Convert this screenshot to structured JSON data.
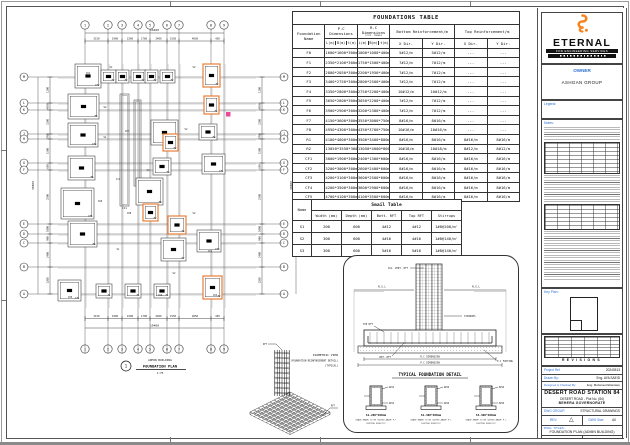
{
  "colors": {
    "accent_orange": "#F5841F",
    "label_blue": "#2E6FD0",
    "highlight_orange": "#E87E3A",
    "marker_pink": "#EC4899"
  },
  "foundations_table": {
    "title": "FOUNDATIONS TABLE",
    "col1": "Foundation Name",
    "pc_header": "P.C Dimensions",
    "rc_header": "R.C Dimensions",
    "rc_subheader": "(col. base)",
    "bottom_header": "Bottom Reinforcement/m",
    "top_header": "Top Reinforcement/m",
    "dim_subcols": [
      "L(m)",
      "B(m)",
      "t(m)"
    ],
    "xdir": "X Dir.",
    "ydir": "Y Dir.",
    "rows": [
      [
        "F0",
        "1600*1600*300mm",
        "1000*1000*400mm",
        "5#12/m",
        "5#12/m",
        "---",
        "---"
      ],
      [
        "F1",
        "2350*2100*300mm",
        "1750*1500*400mm",
        "7#12/m",
        "7#12/m",
        "---",
        "---"
      ],
      [
        "F2",
        "2800*2050*300mm",
        "2200*1950*400mm",
        "7#12/m",
        "7#12/m",
        "---",
        "---"
      ],
      [
        "F3",
        "3400*2750*300mm",
        "2800*2500*400mm",
        "7#12/m",
        "7#12/m",
        "---",
        "---"
      ],
      [
        "F4",
        "3350*2800*300mm",
        "2750*2200*400mm",
        "10#12/m",
        "10#12/m",
        "---",
        "---"
      ],
      [
        "F5",
        "3650*2800*300mm",
        "3050*2200*400mm",
        "7#12/m",
        "7#12/m",
        "---",
        "---"
      ],
      [
        "F6",
        "3900*2900*300mm",
        "3200*2300*400mm",
        "7#12/m",
        "7#12/m",
        "---",
        "---"
      ],
      [
        "F7",
        "4150*3600*300mm",
        "3550*3000*750mm",
        "8#16/m",
        "8#16/m",
        "---",
        "---"
      ],
      [
        "F8",
        "4950*4300*300mm",
        "4350*3700*750mm",
        "10#16/m",
        "10#16/m",
        "---",
        "---"
      ],
      [
        "R1",
        "4100*4000*300mm",
        "3500*3400*800mm",
        "8#16/m",
        "8#16/m",
        "8#16/m",
        "8#16/m"
      ],
      [
        "R2",
        "13050*3550*300mm",
        "13050*4000*800mm",
        "10#18/m",
        "10#18/m",
        "8#12/m",
        "8#12/m"
      ],
      [
        "CF1",
        "3000*1900*300mm",
        "2400*1300*600mm",
        "8#16/m",
        "8#16/m",
        "8#16/m",
        "8#16/m"
      ],
      [
        "CF2",
        "3200*3000*300mm",
        "2600*2400*600mm",
        "8#16/m",
        "8#16/m",
        "8#16/m",
        "8#16/m"
      ],
      [
        "CF3",
        "4200*3100*300mm",
        "3600*2500*600mm",
        "8#16/m",
        "8#16/m",
        "8#16/m",
        "8#16/m"
      ],
      [
        "CF4",
        "4200*3500*300mm",
        "3600*2900*600mm",
        "8#16/m",
        "8#16/m",
        "8#16/m",
        "8#16/m"
      ],
      [
        "CF5",
        "4700*4100*300mm",
        "4100*3500*600mm",
        "8#16/m",
        "8#16/m",
        "8#16/m",
        "8#16/m"
      ]
    ]
  },
  "smail_table": {
    "title": "Smail Table",
    "name_header": "Name",
    "headers": [
      "Width (mm)",
      "Depth (mm)",
      "Bott. RFT",
      "Top RFT",
      "Stirrups"
    ],
    "rows": [
      [
        "S1",
        "200",
        "600",
        "4#12",
        "4#12",
        "1#8@200/m'"
      ],
      [
        "S2",
        "300",
        "600",
        "4#16",
        "4#16",
        "1#8@140/m'"
      ],
      [
        "S3",
        "300",
        "600",
        "5#16",
        "5#16",
        "1#8@140/m'"
      ]
    ]
  },
  "typical_detail": {
    "caption": "TYPICAL FOUNDATION DETAIL",
    "ngl": "N.G.L",
    "rc_dim": "R.C DIMENSION",
    "pc_dim": "P.C DIMENSION",
    "top_rft": "TOP RFT",
    "bot_rft": "BOT. RFT",
    "stirrups": "STIRRUPS",
    "col_rft": "COL. VERT. RFT",
    "pc_label": "P.C FOOTING"
  },
  "grade_beams": {
    "note_line1": "GRADE BEAMS TO BE CASTED ABOVE P.C",
    "note_line2": "FOOTING DIRECTLY",
    "items": [
      {
        "name": "S1-200*600mm",
        "bott": "4#12",
        "top": "4#12"
      },
      {
        "name": "S2-300*600mm",
        "bott": "4#16",
        "top": "4#16"
      },
      {
        "name": "S3-300*600mm",
        "bott": "5#16",
        "top": "5#16"
      }
    ]
  },
  "plan": {
    "title_number": "1",
    "title_line1": "ADMIN BUILDING",
    "title_line2": "FOUNDATION PLAN",
    "title_scale": "1:75",
    "top_total": "19400",
    "left_total": "30800",
    "col_labels": [
      "1",
      "2",
      "3",
      "4",
      "5",
      "6",
      "7",
      "8",
      "9"
    ],
    "col_x": [
      77,
      100,
      114,
      130,
      142,
      159,
      171,
      203,
      216
    ],
    "top_dims": [
      "3150",
      "1900",
      "2200",
      "1700",
      "2400",
      "1550",
      "4050",
      "450"
    ],
    "row_labels": [
      "M",
      "L",
      "K",
      "J",
      "H",
      "G",
      "F",
      "E",
      "D",
      "C",
      "B",
      "A"
    ],
    "row_y": [
      69,
      95,
      102,
      126,
      131,
      155,
      162,
      216,
      226,
      235,
      259,
      286
    ],
    "left_dims": [
      "1200",
      "4850",
      "3200",
      "2700",
      "1500",
      "650",
      "2500",
      "1000",
      "900",
      "2400",
      "1200"
    ],
    "footings": [
      {
        "x": 67,
        "y": 56,
        "w": 26,
        "h": 24,
        "l": "CF2",
        "hl": 0
      },
      {
        "x": 93,
        "y": 62,
        "w": 15,
        "h": 13,
        "l": "F2",
        "hl": 0
      },
      {
        "x": 108,
        "y": 62,
        "w": 13,
        "h": 13,
        "l": "F2",
        "hl": 0
      },
      {
        "x": 123,
        "y": 62,
        "w": 15,
        "h": 13,
        "l": "F2",
        "hl": 0
      },
      {
        "x": 137,
        "y": 62,
        "w": 13,
        "h": 13,
        "l": "F2",
        "hl": 0
      },
      {
        "x": 152,
        "y": 62,
        "w": 15,
        "h": 13,
        "l": "F2",
        "hl": 0
      },
      {
        "x": 195,
        "y": 56,
        "w": 17,
        "h": 23,
        "l": "F2",
        "hl": 1
      },
      {
        "x": 60,
        "y": 86,
        "w": 31,
        "h": 25,
        "l": "F5",
        "hl": 0
      },
      {
        "x": 196,
        "y": 88,
        "w": 15,
        "h": 18,
        "l": "F2",
        "hl": 1
      },
      {
        "x": 60,
        "y": 115,
        "w": 30,
        "h": 24,
        "l": "CF4",
        "hl": 0
      },
      {
        "x": 143,
        "y": 112,
        "w": 27,
        "h": 25,
        "l": "F7",
        "hl": 0
      },
      {
        "x": 191,
        "y": 116,
        "w": 18,
        "h": 16,
        "l": "F4",
        "hl": 0
      },
      {
        "x": 155,
        "y": 126,
        "w": 15,
        "h": 17,
        "l": "F2",
        "hl": 1
      },
      {
        "x": 60,
        "y": 148,
        "w": 27,
        "h": 24,
        "l": "F6",
        "hl": 0
      },
      {
        "x": 145,
        "y": 150,
        "w": 18,
        "h": 17,
        "l": "F3",
        "hl": 0
      },
      {
        "x": 194,
        "y": 146,
        "w": 23,
        "h": 20,
        "l": "CF1",
        "hl": 0
      },
      {
        "x": 53,
        "y": 180,
        "w": 33,
        "h": 31,
        "l": "CF5",
        "hl": 0
      },
      {
        "x": 128,
        "y": 170,
        "w": 27,
        "h": 27,
        "l": "F8",
        "hl": 0
      },
      {
        "x": 135,
        "y": 196,
        "w": 15,
        "h": 17,
        "l": "F2",
        "hl": 1
      },
      {
        "x": 160,
        "y": 208,
        "w": 18,
        "h": 18,
        "l": "F4",
        "hl": 1
      },
      {
        "x": 60,
        "y": 213,
        "w": 29,
        "h": 26,
        "l": "F6",
        "hl": 0
      },
      {
        "x": 153,
        "y": 230,
        "w": 25,
        "h": 23,
        "l": "F7",
        "hl": 0
      },
      {
        "x": 189,
        "y": 222,
        "w": 24,
        "h": 22,
        "l": "CF3",
        "hl": 0
      },
      {
        "x": 50,
        "y": 272,
        "w": 23,
        "h": 21,
        "l": "CF1",
        "hl": 0
      },
      {
        "x": 88,
        "y": 276,
        "w": 16,
        "h": 14,
        "l": "F1",
        "hl": 0
      },
      {
        "x": 117,
        "y": 276,
        "w": 16,
        "h": 14,
        "l": "F1",
        "hl": 0
      },
      {
        "x": 146,
        "y": 276,
        "w": 16,
        "h": 14,
        "l": "F1",
        "hl": 0
      },
      {
        "x": 195,
        "y": 268,
        "w": 19,
        "h": 23,
        "l": "F2",
        "hl": 1
      }
    ],
    "strips": [
      {
        "x": 112,
        "y": 86,
        "w": 9,
        "h": 112,
        "l": "C11"
      },
      {
        "x": 126,
        "y": 92,
        "w": 7,
        "h": 86,
        "l": ""
      }
    ],
    "beam_labels": [
      {
        "t": "S1",
        "x": 103,
        "y": 60
      },
      {
        "t": "S2",
        "x": 186,
        "y": 60
      },
      {
        "t": "S2",
        "x": 97,
        "y": 100
      },
      {
        "t": "S1",
        "x": 97,
        "y": 130
      },
      {
        "t": "S2",
        "x": 178,
        "y": 122
      },
      {
        "t": "S3",
        "x": 140,
        "y": 163
      },
      {
        "t": "S2",
        "x": 186,
        "y": 206
      },
      {
        "t": "S1",
        "x": 110,
        "y": 242
      },
      {
        "t": "S2",
        "x": 166,
        "y": 266
      },
      {
        "t": "C07",
        "x": 119,
        "y": 124
      },
      {
        "t": "C11",
        "x": 110,
        "y": 172
      },
      {
        "t": "C08",
        "x": 121,
        "y": 206
      },
      {
        "t": "C06",
        "x": 92,
        "y": 194
      },
      {
        "t": "C04",
        "x": 152,
        "y": 288
      },
      {
        "t": "C05",
        "x": 62,
        "y": 290
      },
      {
        "t": "C09",
        "x": 202,
        "y": 244
      },
      {
        "t": "C03",
        "x": 207,
        "y": 288
      },
      {
        "t": "C01",
        "x": 80,
        "y": 66
      }
    ]
  },
  "isometric": {
    "line1": "ISOMETRIC VIEW",
    "line2": "(FOUNDATION REINFORCEMENT DETAIL)",
    "line3": "(TYPICAL)",
    "flag1": "RFT",
    "flag2": "RFT"
  },
  "right_panel": {
    "logo": {
      "name": "ETERNAL",
      "tagline": "FOR ENGINEERING SERVICES"
    },
    "owner": {
      "label": "OWNER",
      "value": "ASHGAN GROUP"
    },
    "legend_label": "Legend:",
    "notes_label": "Notes:",
    "keyplan_label": "Key Plan:",
    "revisions_label": "Revisions:",
    "revisions_footer": "REVISIONS",
    "titleblock": {
      "project_ref_label": "Project Ref",
      "project_ref": "20240513",
      "drawn_by_label": "Drawn By:",
      "drawn_by": "Eng. AYA SAEID",
      "designed_label": "Designed & Checked By:",
      "designed_by": "Eng. Mohamed Eltantawy",
      "project_line1": "DESERT ROAD STATION 84",
      "project_line2": "DESERT ROAD - Plot No. (84)",
      "project_line3": "BEHERA GOVERNORATE",
      "dwg_group_label": "DWG GROUP:",
      "dwg_group": "STRUCTURAL DRAWINGS",
      "rev_label": "REV:",
      "rev_symbol": "triangle",
      "dwg_size_label": "DWG Size:",
      "dwg_size": "A0",
      "dwg_titles_label": "DWG. TITLES:",
      "dwg_title": "FOUNDATION PLAN (ADMIN BUILDING)",
      "drawing_no_label": "DRAWING NO:",
      "drawing_no": "ST-00",
      "scale_label": "SCALE:",
      "scale": "AS SHOWN"
    }
  }
}
